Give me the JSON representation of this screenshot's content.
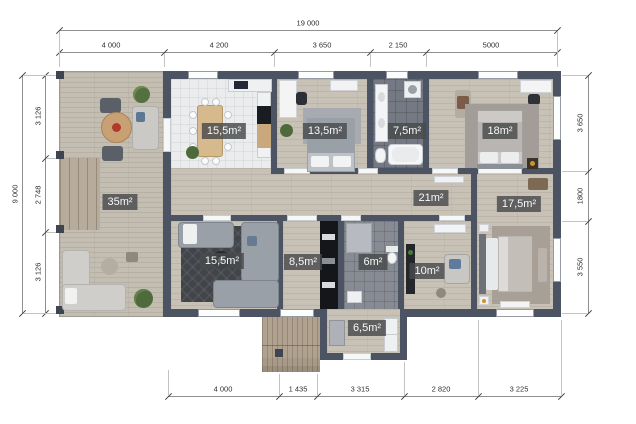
{
  "title": "house-floor-plan",
  "colors": {
    "wall": "#4c5362",
    "wood_floor": "#c8c1b6",
    "terrace_floor": "#c3bdb2",
    "white_tile": "#eaecee",
    "dark_tile": "#747983",
    "gray_tile": "#878b93",
    "label_bg": "#48494b",
    "label_text": "#f8f8f8"
  },
  "dimensions": {
    "top": {
      "total": "19 000",
      "segments": [
        "4 000",
        "4 200",
        "3 650",
        "2 150",
        "5000"
      ]
    },
    "bottom": {
      "segments": [
        "4 000",
        "1 435",
        "3 315",
        "2 820",
        "3 225"
      ]
    },
    "left": {
      "total": "9 000",
      "segments": [
        "3 126",
        "2 748",
        "3 126"
      ]
    },
    "right": {
      "segments": [
        "3 650",
        "1800",
        "3 550"
      ]
    }
  },
  "rooms": {
    "terrace": {
      "label": "35m²"
    },
    "dining": {
      "label": "15,5m²"
    },
    "bedroom1": {
      "label": "13,5m²"
    },
    "bathroom": {
      "label": "7,5m²"
    },
    "bedroom2": {
      "label": "18m²"
    },
    "hallway": {
      "label": "21m²"
    },
    "living": {
      "label": "15,5m²"
    },
    "kitchen": {
      "label": "8,5m²"
    },
    "wc": {
      "label": "6m²"
    },
    "bedroom3": {
      "label": "10m²"
    },
    "master": {
      "label": "17,5m²"
    },
    "entry": {
      "label": "6,5m²"
    }
  }
}
